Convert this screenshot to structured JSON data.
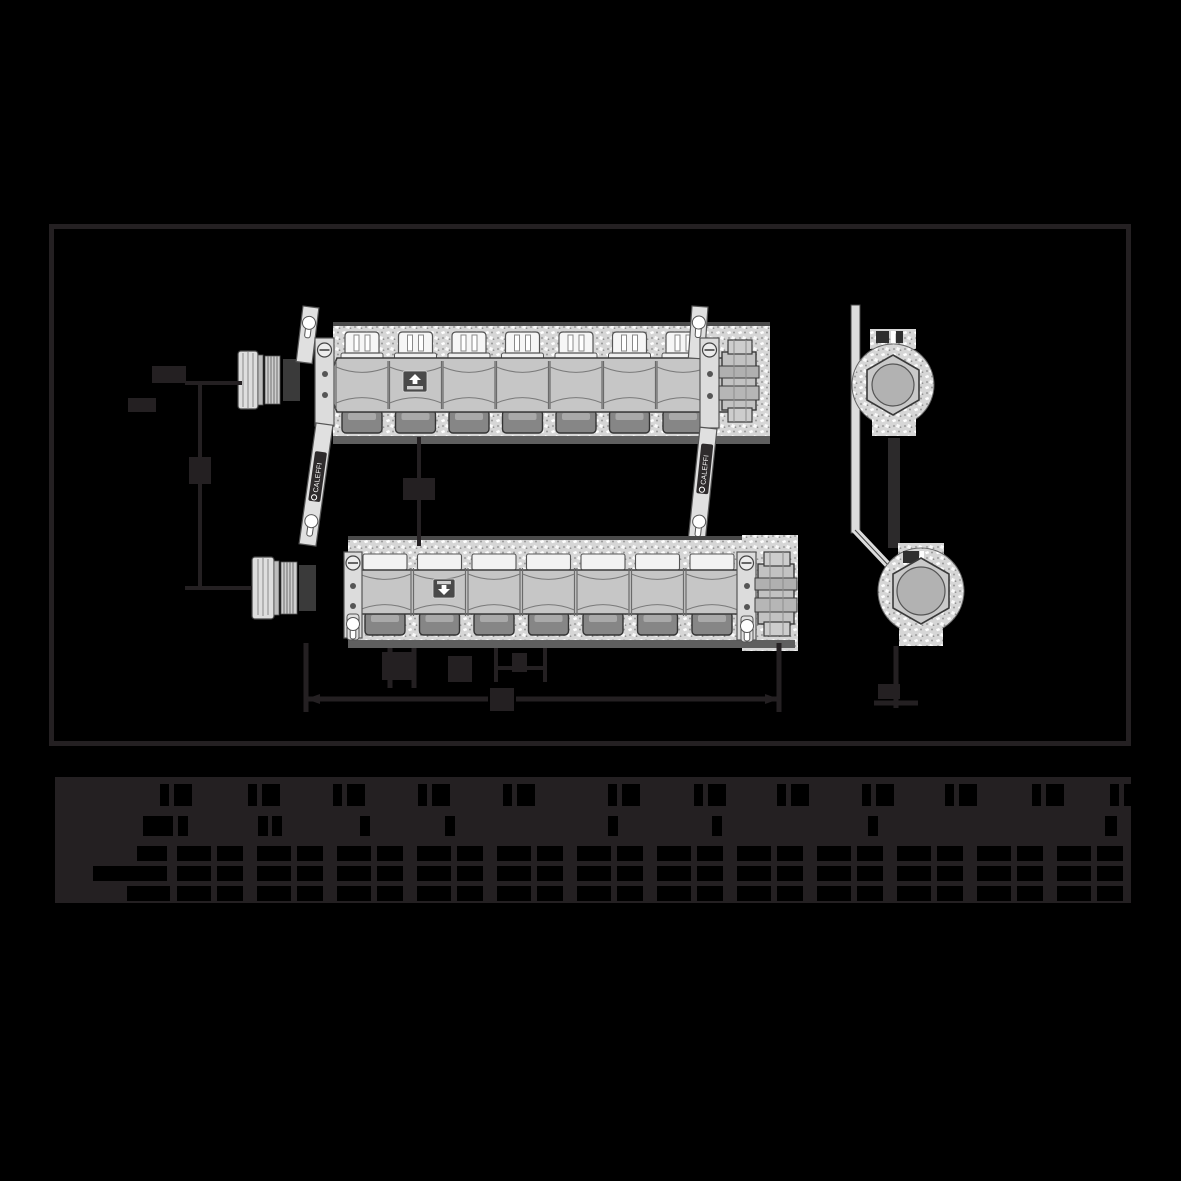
{
  "meta": {
    "description": "Technical dimensional drawing of a pre-assembled heating distribution manifold pair (flow and return) with wall brackets, shown in front view and side view, above a dimensions table. Rendered on a black background; all ink is near-black charcoal so dimension letters and table text are not legible.",
    "brand": {
      "label": "CALEFFI"
    }
  },
  "colors": {
    "background": "#000000",
    "ink": "#242022",
    "body_gray": "#c6c6c6",
    "cap_white": "#f3f3f3",
    "bracket_gray": "#e0e0e0",
    "outlet_gray": "#868686",
    "stipple_base": "#d6d6d6",
    "inner_circle_gray": "#b2b2b2",
    "label_bg": "#2e2b2c",
    "label_text": "#ffffff"
  },
  "drawing": {
    "frame": {
      "x": 49,
      "y": 224,
      "w": 1082,
      "h": 522
    },
    "top_manifold": {
      "name": "flow manifold with valve caps",
      "valve_caps": {
        "count": 7,
        "start": 362,
        "pitch": 53.5
      },
      "outlets": {
        "count": 7,
        "start": 362,
        "pitch": 53.5
      },
      "segments": {
        "count": 7,
        "start": 362,
        "pitch": 53.5
      },
      "badge_arrow": "up"
    },
    "bottom_manifold": {
      "name": "return manifold with lockshield caps",
      "valve_caps": {
        "count": 7,
        "start": 385,
        "pitch": 54.5
      },
      "outlets": {
        "count": 7,
        "start": 385,
        "pitch": 54.5
      },
      "segments": {
        "count": 7,
        "start": 385,
        "pitch": 54.5
      },
      "badge_arrow": "down"
    },
    "side_view": {
      "circles": 2
    },
    "bracket_labels": [
      {
        "text": "CALEFFI"
      },
      {
        "text": "CALEFFI"
      }
    ]
  },
  "table": {
    "x": 55,
    "y": 777,
    "width": 1076,
    "height": 126,
    "header_marks": {
      "row1_y": 7,
      "row1_h": 22,
      "row1_pairs_x": [
        105,
        193,
        278,
        363,
        448,
        553,
        639,
        722,
        807,
        890,
        977,
        1055
      ],
      "row1_pair_widths": [
        9,
        18
      ],
      "row1_pair_gap": 14,
      "row2_y": 39,
      "row2_h": 20,
      "row2_rects": [
        [
          88,
          30
        ],
        [
          123,
          10
        ],
        [
          203,
          10
        ],
        [
          217,
          10
        ],
        [
          305,
          10
        ],
        [
          390,
          10
        ],
        [
          553,
          10
        ],
        [
          657,
          10
        ],
        [
          813,
          10
        ],
        [
          1050,
          12
        ]
      ]
    },
    "body_rows": [
      {
        "y": 69,
        "h": 15,
        "label_cell": [
          82,
          30
        ]
      },
      {
        "y": 89,
        "h": 15,
        "label_cell": [
          38,
          74
        ]
      },
      {
        "y": 109,
        "h": 15,
        "label_cell": [
          72,
          43
        ]
      }
    ],
    "pairs": {
      "start": 122,
      "pitch": 80,
      "count": 12,
      "cells": [
        [
          0,
          34
        ],
        [
          40,
          26
        ]
      ]
    }
  }
}
